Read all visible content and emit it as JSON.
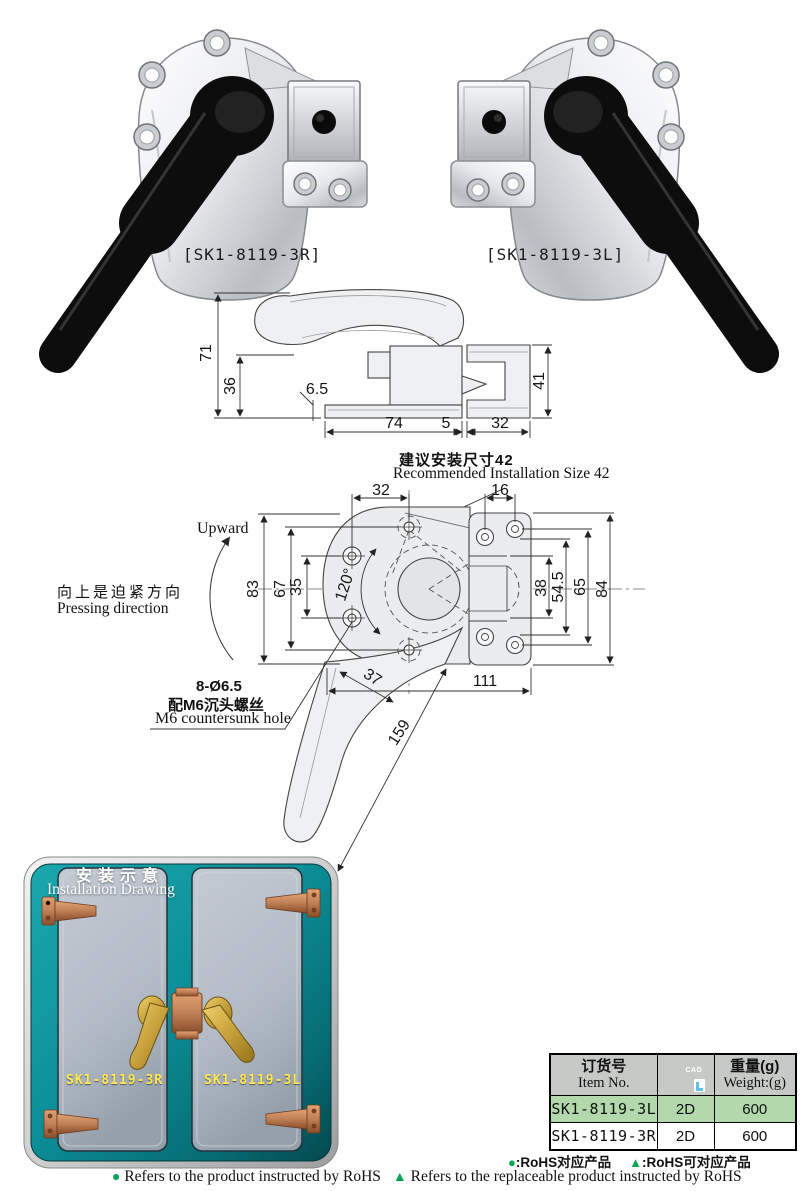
{
  "products": {
    "left_label": "[SK1-8119-3R]",
    "right_label": "[SK1-8119-3L]"
  },
  "side_view": {
    "dims": {
      "total_height": "71",
      "base_height": "36",
      "offset": "6.5",
      "base_width": "74",
      "gap": "5",
      "keeper_width": "32",
      "keeper_height": "41"
    }
  },
  "install_note": {
    "zh": "建议安装尺寸42",
    "en": "Recommended Installation Size 42"
  },
  "front_view": {
    "dims": {
      "top_left": "32",
      "top_right": "16",
      "left_outer": "83",
      "left_mid": "67",
      "left_inner": "35",
      "angle": "120°",
      "handle_width": "37",
      "handle_length": "159",
      "right_inner": "38",
      "right_mid": "54.5",
      "right_mid2": "65",
      "right_outer": "84",
      "bottom": "111"
    },
    "annotations": {
      "upward": "Upward",
      "pressing_zh": "向上是迫紧方向",
      "pressing_en": "Pressing direction",
      "hole_spec": "8-Ø6.5",
      "hole_zh": "配M6沉头螺丝",
      "hole_en": "M6 countersunk hole"
    }
  },
  "installation": {
    "title_zh": "安装示意",
    "title_en": "Installation Drawing",
    "left_door_label": "SK1-8119-3R",
    "right_door_label": "SK1-8119-3L"
  },
  "table": {
    "header": {
      "item_zh": "订货号",
      "item_en": "Item No.",
      "cad_label": "CAD",
      "weight_zh": "重量(g)",
      "weight_en": "Weight:(g)"
    },
    "rows": [
      {
        "item": "SK1-8119-3L",
        "cad": "2D",
        "weight": "600"
      },
      {
        "item": "SK1-8119-3R",
        "cad": "2D",
        "weight": "600"
      }
    ]
  },
  "legend": {
    "zh": {
      "dot_symbol": "●",
      "dot_text": ":RoHS对应产品",
      "tri_symbol": "▲",
      "tri_text": ":RoHS可对应产品"
    },
    "en": {
      "dot_symbol": "●",
      "dot_text": "Refers to the product instructed by RoHS",
      "tri_symbol": "▲",
      "tri_text": "Refers to the replaceable product instructed by RoHS"
    }
  },
  "colors": {
    "accent_green": "#00a651",
    "row_highlight": "#b2d8ac",
    "header_gray": "#c6cac6",
    "cad_blue": "#5fc0e8",
    "teal_panel": "#0c9099",
    "teal_dark": "#03494e",
    "door_gray": "#b3bcc6",
    "hinge_copper": "#c08055",
    "handle_gold": "#c8a23c",
    "label_yellow": "#ffe94e"
  }
}
